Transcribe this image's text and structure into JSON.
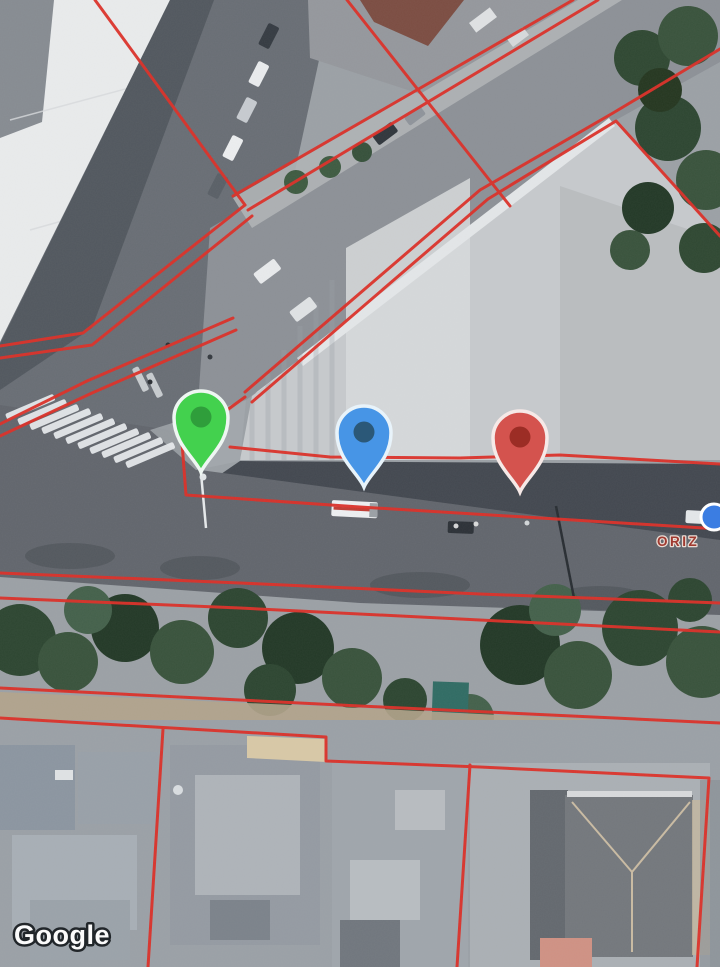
{
  "map": {
    "view_type": "satellite",
    "attribution": "Google",
    "poi_label_fragment": "ORIZ",
    "overlay": {
      "parcel_line_color": "#dc2f27"
    },
    "markers": [
      {
        "name": "green-pin",
        "shape": "teardrop-pin",
        "body_color": "#43d14e",
        "inner_dot_color": "#2f9e3b",
        "outline_color": "#eef6f2",
        "tip_x": 201,
        "tip_y": 472
      },
      {
        "name": "blue-pin",
        "shape": "teardrop-pin",
        "body_color": "#4795e6",
        "inner_dot_color": "#2b5878",
        "outline_color": "#e8f3fa",
        "tip_x": 364,
        "tip_y": 487
      },
      {
        "name": "red-pin",
        "shape": "teardrop-pin",
        "body_color": "#d4534e",
        "inner_dot_color": "#9c2d25",
        "outline_color": "#f6e9e7",
        "tip_x": 520,
        "tip_y": 492
      },
      {
        "name": "blue-dot",
        "shape": "circle",
        "body_color": "#3b7de2",
        "outline_color": "#ffffff",
        "x": 714,
        "y": 517
      }
    ]
  }
}
